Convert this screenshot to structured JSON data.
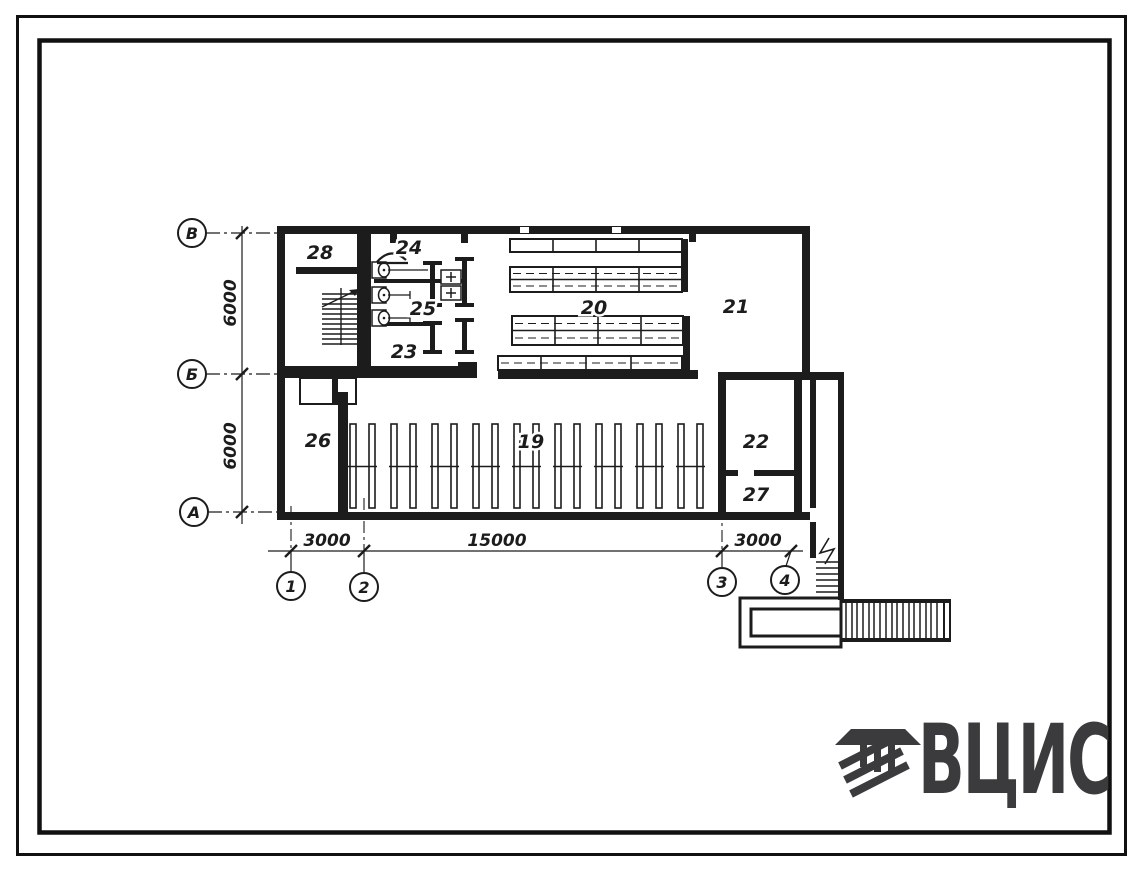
{
  "logo": {
    "text": "ВЦИС",
    "color": "#3b3b3d"
  },
  "plan": {
    "ink": "#1c1c1c",
    "row_axes": [
      {
        "label": "В"
      },
      {
        "label": "Б"
      },
      {
        "label": "А"
      }
    ],
    "col_axes": [
      {
        "label": "1"
      },
      {
        "label": "2"
      },
      {
        "label": "3"
      },
      {
        "label": "4"
      }
    ],
    "dims_left": [
      {
        "label": "6000"
      },
      {
        "label": "6000"
      }
    ],
    "dims_bottom": [
      {
        "label": "3000"
      },
      {
        "label": "15000"
      },
      {
        "label": "3000"
      }
    ],
    "rooms": [
      {
        "label": "28"
      },
      {
        "label": "24"
      },
      {
        "label": "25"
      },
      {
        "label": "23"
      },
      {
        "label": "20"
      },
      {
        "label": "21"
      },
      {
        "label": "26"
      },
      {
        "label": "19"
      },
      {
        "label": "22"
      },
      {
        "label": "27"
      }
    ]
  }
}
